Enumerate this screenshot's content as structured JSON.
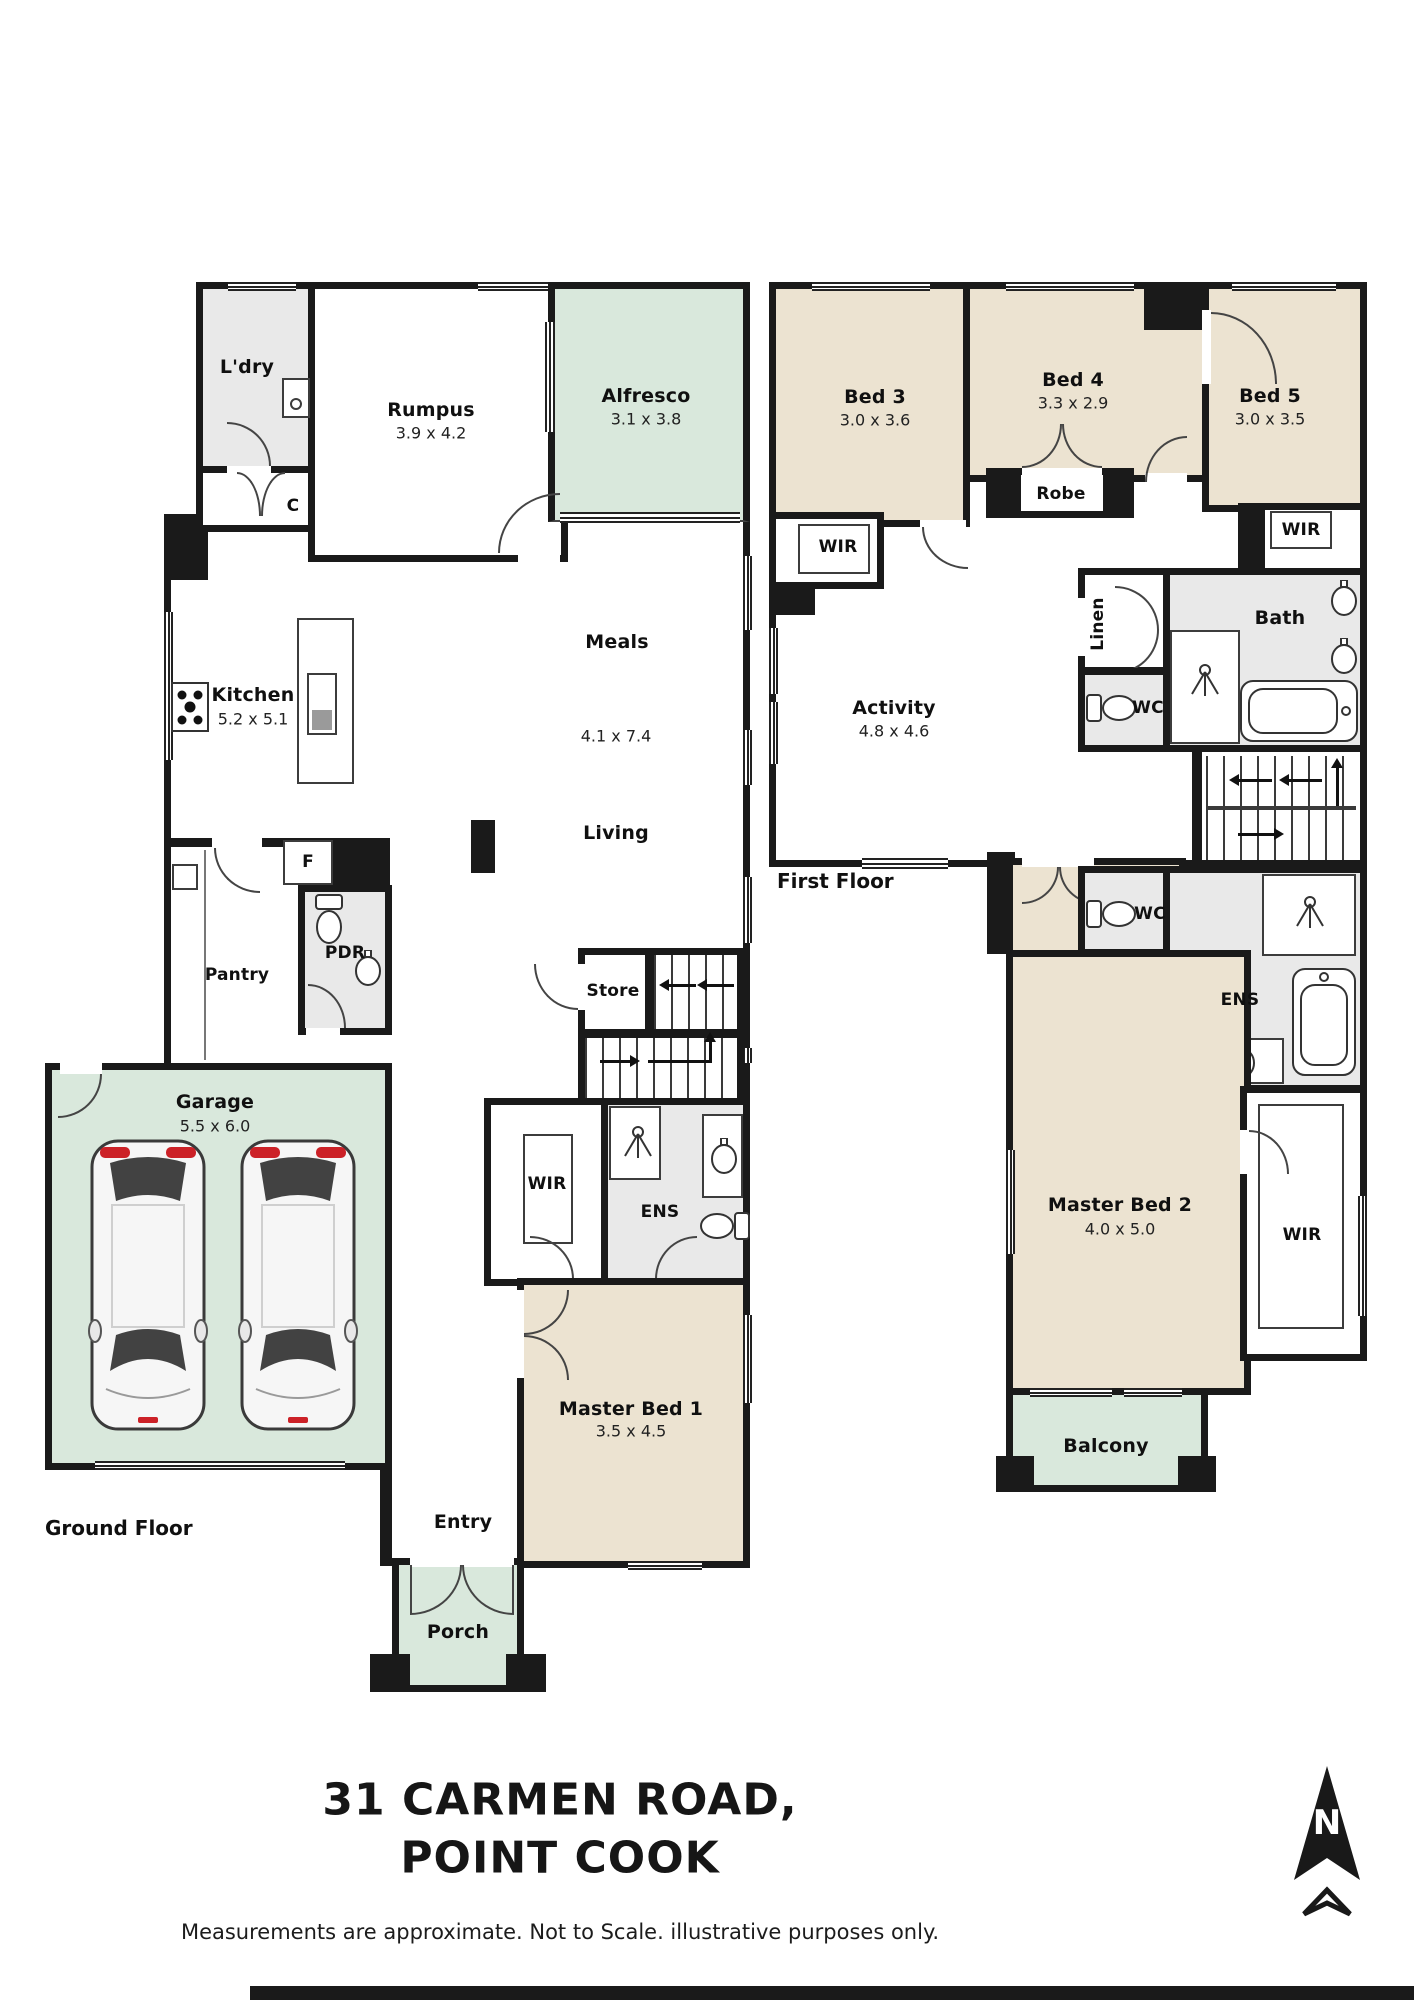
{
  "title": {
    "line1": "31 CARMEN ROAD,",
    "line2": "POINT COOK"
  },
  "disclaimer": "Measurements are approximate. Not to Scale. illustrative purposes only.",
  "compass": {
    "n": "N"
  },
  "colors": {
    "wall": "#1a1a1a",
    "bedroom_fill": "#ece3d1",
    "outdoor_fill": "#d9e8dc",
    "wet_area_fill": "#e9e9e9",
    "accent_red": "#cc2127"
  },
  "ground": {
    "floor_label": "Ground Floor",
    "ldry": "L'dry",
    "c": "C",
    "rumpus": {
      "name": "Rumpus",
      "dims": "3.9 x 4.2"
    },
    "alfresco": {
      "name": "Alfresco",
      "dims": "3.1 x 3.8"
    },
    "kitchen": {
      "name": "Kitchen",
      "dims": "5.2 x 5.1"
    },
    "meals": "Meals",
    "living": "Living",
    "living_dims": "4.1 x 7.4",
    "fridge": "F",
    "pantry": "Pantry",
    "pdr": "PDR",
    "store": "Store",
    "garage": {
      "name": "Garage",
      "dims": "5.5 x 6.0"
    },
    "wir": "WIR",
    "ens": "ENS",
    "master1": {
      "name": "Master Bed 1",
      "dims": "3.5 x 4.5"
    },
    "entry": "Entry",
    "porch": "Porch"
  },
  "first": {
    "floor_label": "First Floor",
    "bed3": {
      "name": "Bed 3",
      "dims": "3.0 x 3.6"
    },
    "bed4": {
      "name": "Bed 4",
      "dims": "3.3 x 2.9"
    },
    "bed5": {
      "name": "Bed 5",
      "dims": "3.0 x 3.5"
    },
    "wir_bed3": "WIR",
    "robe": "Robe",
    "wir_bed5": "WIR",
    "bath": "Bath",
    "linen": "Linen",
    "wc_upper": "WC",
    "activity": {
      "name": "Activity",
      "dims": "4.8 x 4.6"
    },
    "wc_lower": "WC",
    "ens": "ENS",
    "master2": {
      "name": "Master Bed 2",
      "dims": "4.0 x 5.0"
    },
    "wir_master2": "WIR",
    "balcony": "Balcony"
  }
}
